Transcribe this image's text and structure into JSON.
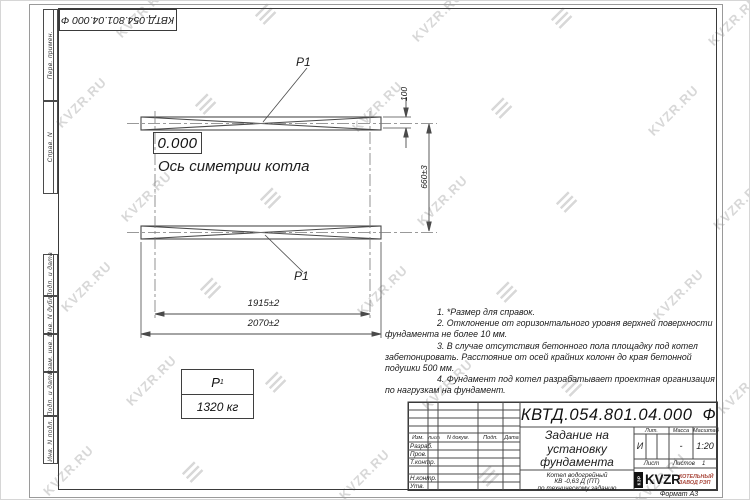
{
  "colors": {
    "line": "#4a4a4a",
    "watermark": "#d8d8d8",
    "logo_red": "#a8463a"
  },
  "watermark": {
    "text": "KVZR.RU"
  },
  "frame": {
    "top_ref_number": "КВТД.054.801.04.000  Ф",
    "left_labels": [
      "Перв. примен.",
      "Справ. N",
      "Подп. и дата",
      "Инв. N дубл.",
      "Взам. инв. N",
      "Подп. и дата",
      "Инв. N подл."
    ],
    "format_label": "Формат А3"
  },
  "drawing": {
    "p1_label": "P1",
    "zero_level": "0.000",
    "axis_caption": "Ось симетрии котла",
    "dims": {
      "inner_width": "1915±2",
      "outer_width": "2070±2",
      "strip_width": "100",
      "strip_spacing": "660±3"
    },
    "load_table": {
      "symbol": "P",
      "symbol_index": "1",
      "value": "1320 кг"
    }
  },
  "notes": {
    "lines": [
      "1. *Размер для справок.",
      "2. Отклонение от горизонтального уровня верхней поверхности",
      "фундамента не более 10 мм.",
      "3. В случае отсутствия бетонного пола площадку под котел",
      "забетонировать. Расстояние от осей крайних колонн до края бетонной",
      "подушки 500 мм.",
      "4. Фундамент под котел разрабатывает проектная организация",
      "по нагрузкам на фундамент."
    ]
  },
  "title_block": {
    "doc_number": "КВТД.054.801.04.000",
    "doc_suffix": "Ф",
    "title_lines": [
      "Задание на",
      "установку",
      "фундамента"
    ],
    "subtitle_lines": [
      "Котел водогрейный",
      "КВ -0,63 Д (ПТ)",
      "по техническому заданию"
    ],
    "header_cells": [
      "Изм.",
      "Лист",
      "N докум.",
      "Подп.",
      "Дата"
    ],
    "row_labels": [
      "Разраб.",
      "Пров.",
      "Т.контр.",
      "Н.контр.",
      "Утв."
    ],
    "lit_header": [
      "Лит.",
      "Масса",
      "Масштаб"
    ],
    "lit_value": "И",
    "mass_value": "-",
    "scale_value": "1:20",
    "sheet_label": "Лист",
    "sheets_label": "Листов",
    "sheets_value": "1",
    "logo_mark": "КЗР",
    "logo_text": "KVZR",
    "logo_sub": [
      "КОТЕЛЬНЫЙ",
      "ЗАВОД РЭП"
    ]
  }
}
